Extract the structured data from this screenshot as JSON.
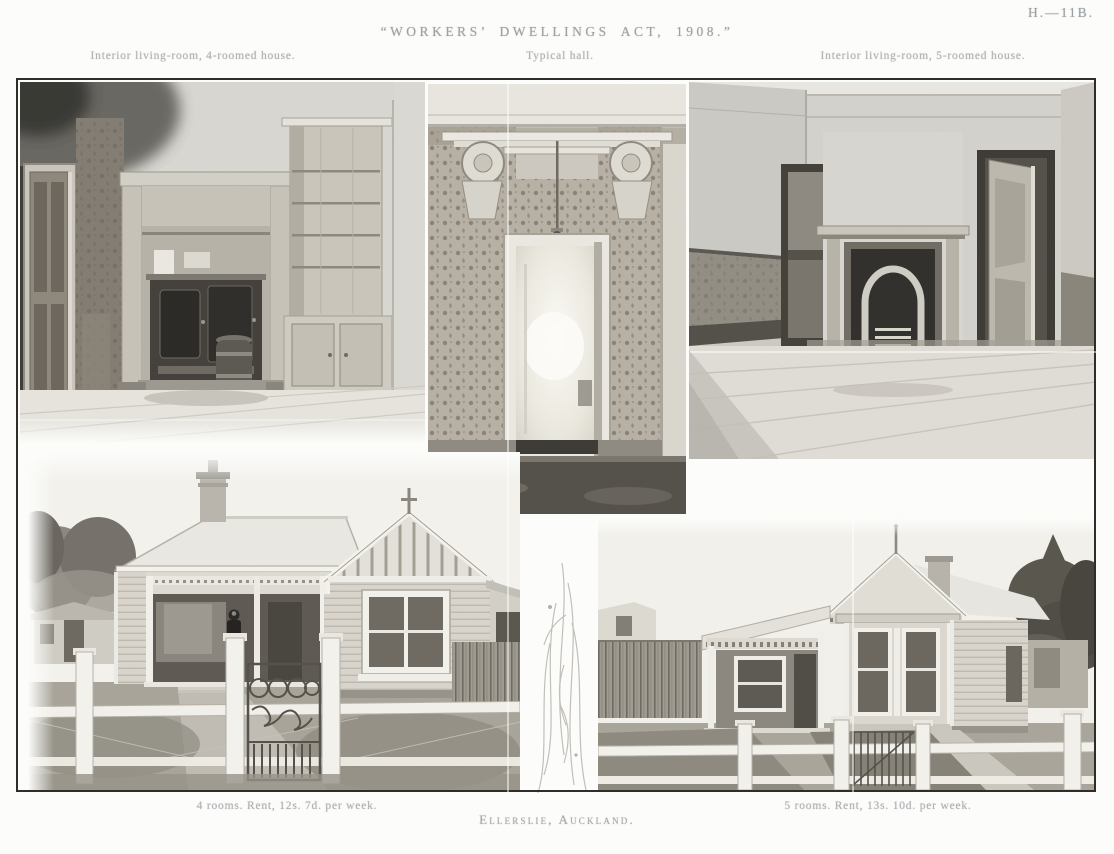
{
  "page": {
    "plate_number": "H.—11B.",
    "title": "“WORKERS’ DWELLINGS ACT, 1908.”",
    "captions": {
      "top_left": "Interior living-room, 4-roomed house.",
      "top_center": "Typical hall.",
      "top_right": "Interior living-room, 5-roomed house.",
      "bottom_left": "4 rooms. Rent, 12s. 7d. per week.",
      "bottom_right": "5 rooms. Rent, 13s. 10d. per week.",
      "footer_location": "Ellerslie, Auckland."
    },
    "colors": {
      "paper": "#fcfcfa",
      "ink": "#9aa0a4",
      "frame_border": "#2e2d2a"
    }
  }
}
